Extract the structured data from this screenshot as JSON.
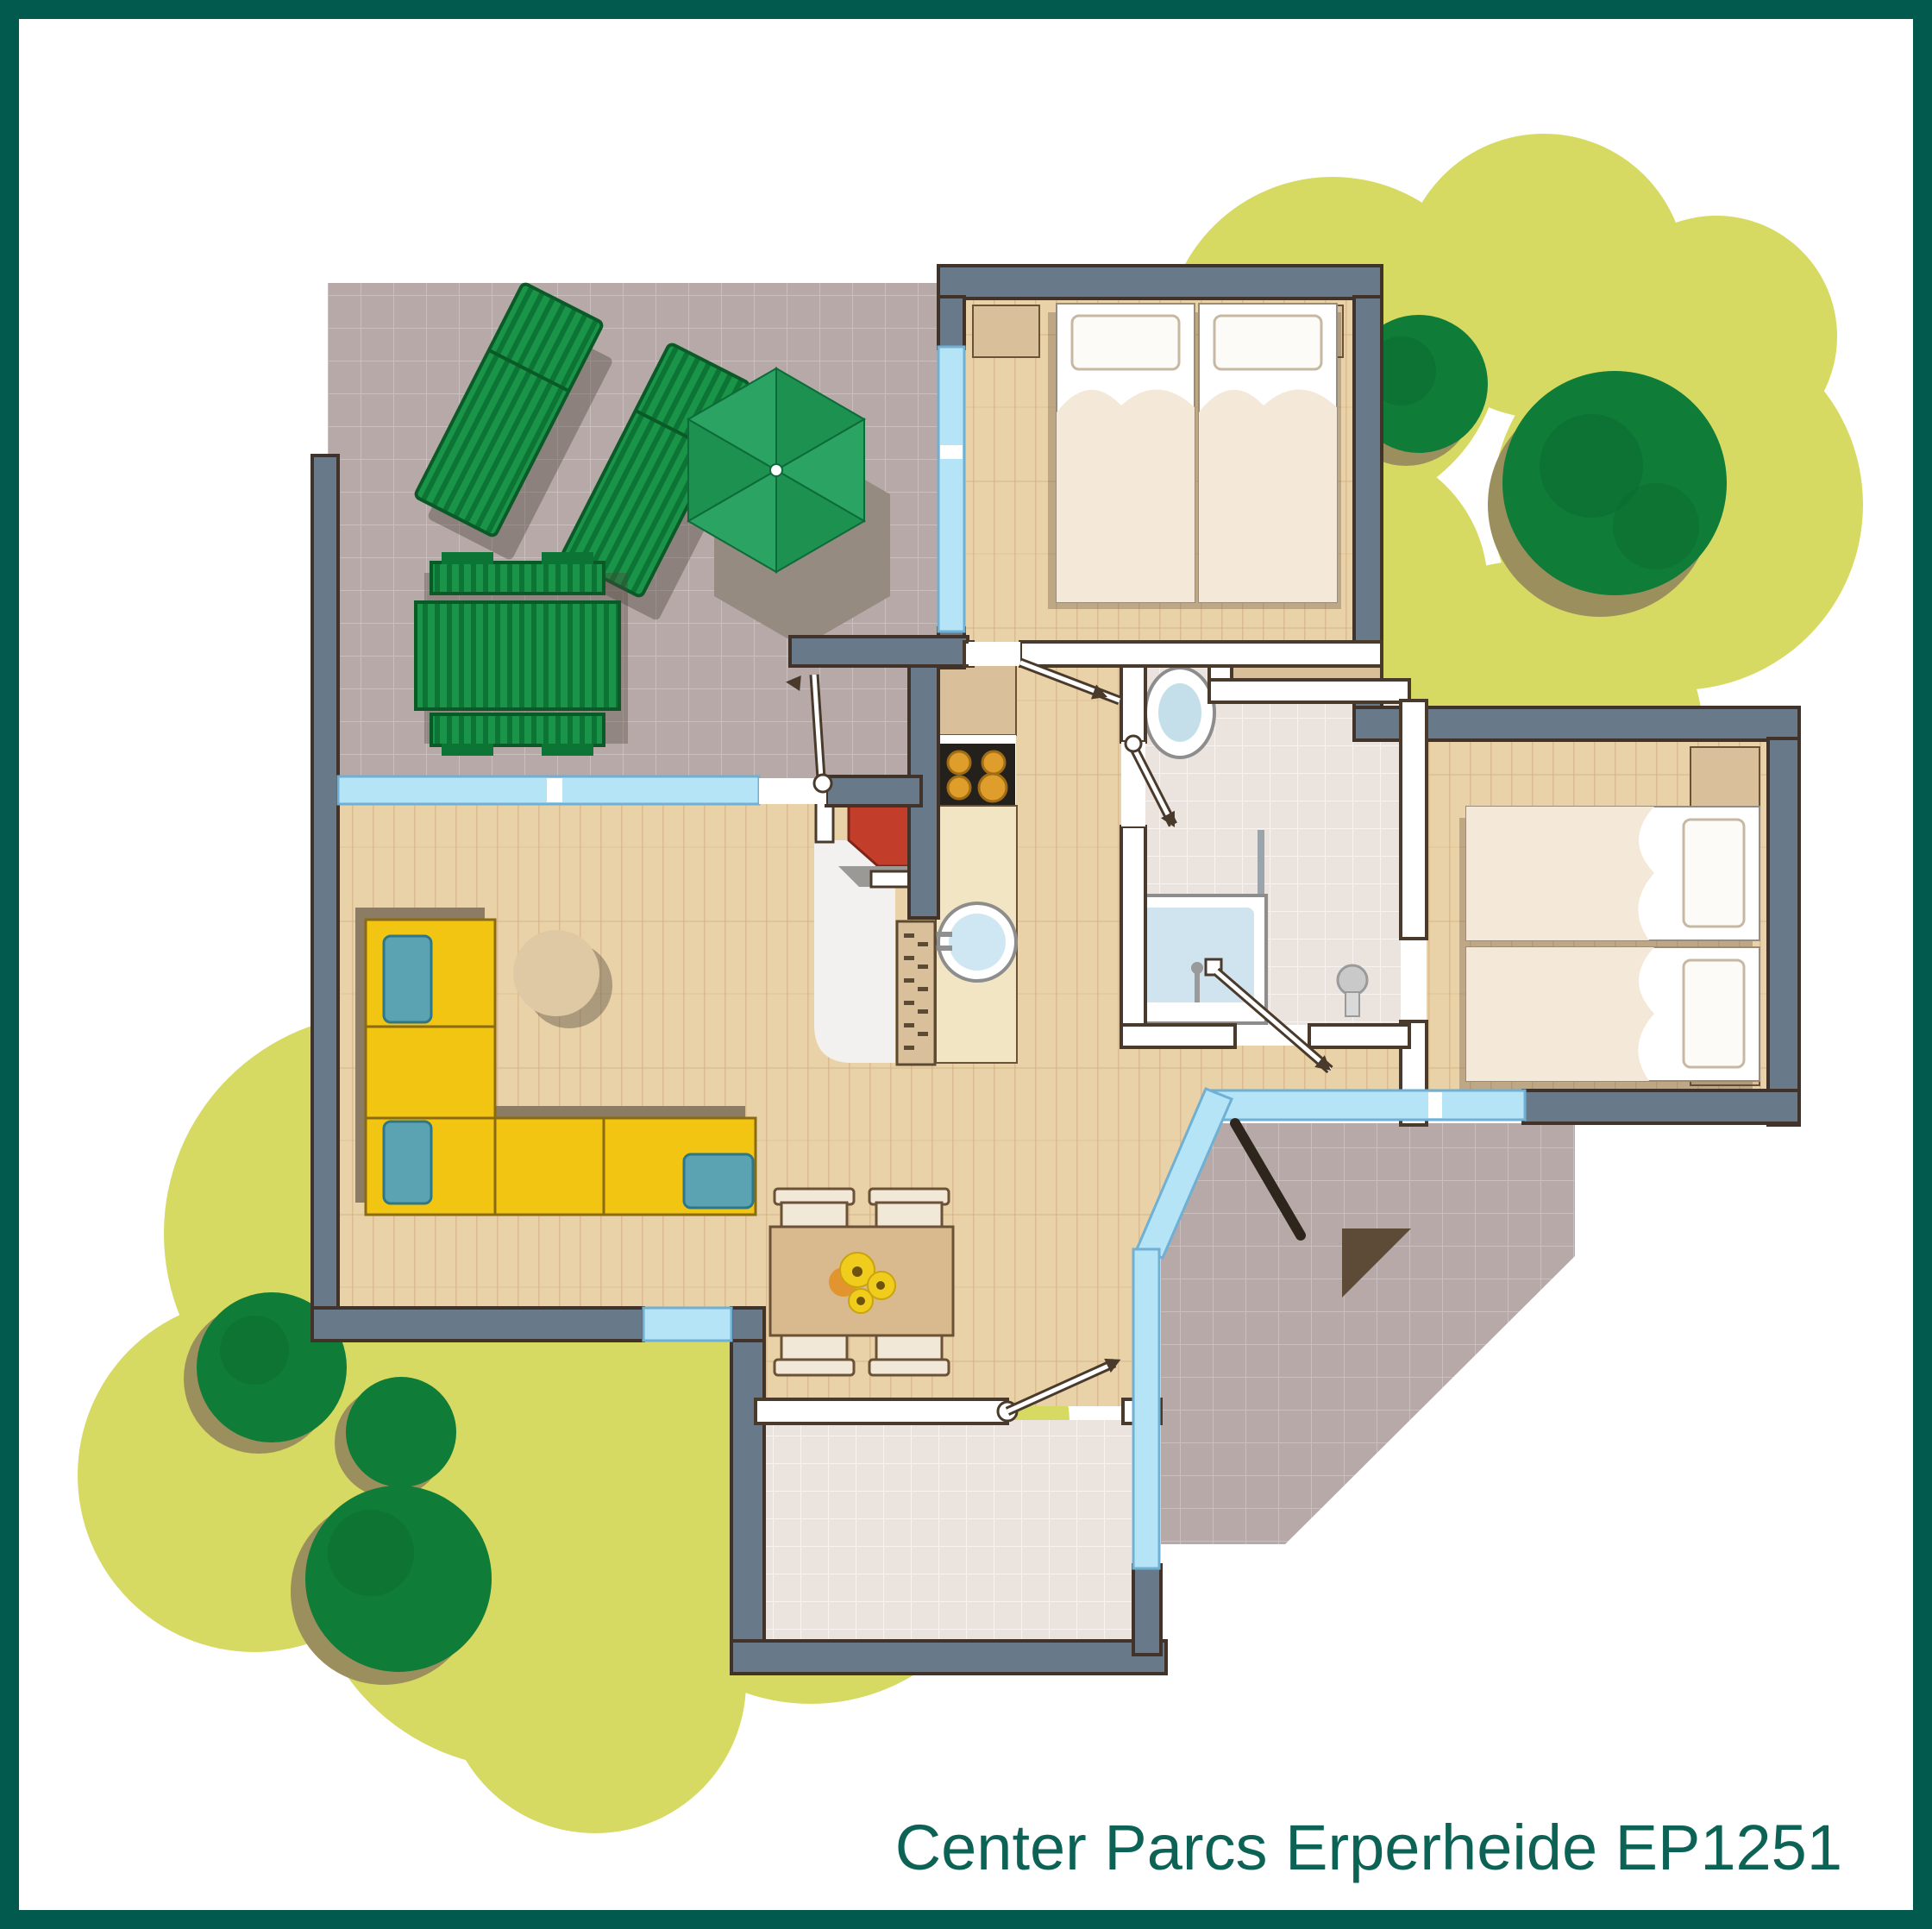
{
  "caption": {
    "text": "Center Parcs Erperheide EP1251",
    "color": "#0c6355"
  },
  "frame": {
    "color": "#015a4d"
  },
  "palette": {
    "garden_green": "#d6da62",
    "tree_green": "#0f7c38",
    "tree_shadow": "#9c8f5e",
    "terrace_tile": "#b6a9a8",
    "wood_floor": "#e9d2a8",
    "bath_tile": "#ebe3de",
    "exterior_wall": "#68798a",
    "wall_outline": "#42332a",
    "window_glass": "#b5e4f6",
    "sofa_yellow": "#f2c513",
    "cushion_blue": "#5ba3b2",
    "fireplace_red": "#c23e2b",
    "parasol_green": "#1d9150",
    "bed_linen": "#f4e9d8"
  },
  "plan": {
    "type": "cottage-floor-plan",
    "outdoor": {
      "terrace_furniture": [
        "sun-lounger",
        "sun-lounger",
        "parasol",
        "picnic-table"
      ],
      "garden": [
        "lawn-blob-top-right",
        "lawn-blob-bottom-left",
        "tree-small",
        "tree-large",
        "bush-1",
        "bush-2",
        "bush-3"
      ],
      "porch": [
        "entrance-triangle-marker",
        "open-door-leaf"
      ]
    },
    "rooms": [
      {
        "name": "terrace",
        "floor": "tile"
      },
      {
        "name": "bedroom-1",
        "furniture": [
          "double-bed",
          "nightstand",
          "nightstand"
        ],
        "floor": "wood"
      },
      {
        "name": "bedroom-2",
        "furniture": [
          "twin-bed",
          "twin-bed",
          "nightstand",
          "nightstand"
        ],
        "floor": "wood"
      },
      {
        "name": "bathroom",
        "furniture": [
          "toilet",
          "bathtub",
          "shower"
        ],
        "floor": "tile"
      },
      {
        "name": "kitchen",
        "furniture": [
          "stove-4-burner",
          "sink",
          "cabinet",
          "radiator",
          "fireplace"
        ],
        "floor": "wood"
      },
      {
        "name": "living-room",
        "furniture": [
          "corner-sofa",
          "round-coffee-table"
        ],
        "floor": "wood"
      },
      {
        "name": "dining-area",
        "furniture": [
          "dining-table",
          "chair",
          "chair",
          "chair",
          "chair",
          "flower-centerpiece"
        ],
        "floor": "wood"
      },
      {
        "name": "entrance-hall",
        "floor": "tile"
      }
    ]
  }
}
